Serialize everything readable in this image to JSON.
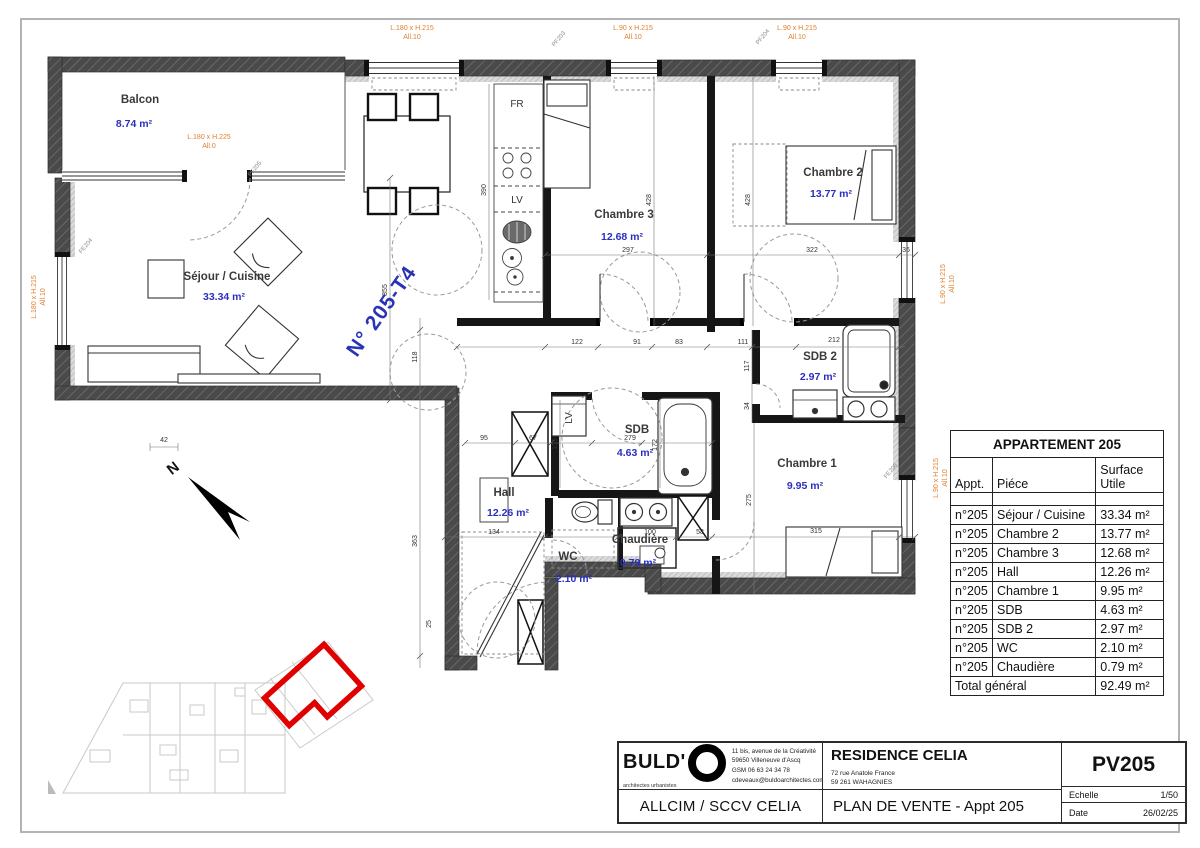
{
  "plan": {
    "unit_label": "N° 205-T4",
    "north": "N",
    "rooms": [
      {
        "name": "Balcon",
        "area": "8.74 m²"
      },
      {
        "name": "Séjour / Cuisine",
        "area": "33.34 m²"
      },
      {
        "name": "Chambre 3",
        "area": "12.68 m²"
      },
      {
        "name": "Chambre 2",
        "area": "13.77 m²"
      },
      {
        "name": "SDB 2",
        "area": "2.97 m²"
      },
      {
        "name": "SDB",
        "area": "4.63 m²"
      },
      {
        "name": "Chambre 1",
        "area": "9.95 m²"
      },
      {
        "name": "Hall",
        "area": "12.26 m²"
      },
      {
        "name": "WC",
        "area": "2.10 m²"
      },
      {
        "name": "Chaudière",
        "area": "0.79 m²"
      }
    ],
    "kitchen": {
      "fridge": "FR",
      "dishwasher": "LV"
    },
    "laundry": "LV",
    "window_labels": [
      {
        "size": "L.180 x H.215",
        "sill": "All.10"
      },
      {
        "size": "L.90 x H.215",
        "sill": "All.10"
      },
      {
        "size": "L.90 x H.215",
        "sill": "All.10"
      },
      {
        "size": "L.180 x H.225",
        "sill": "All.0"
      },
      {
        "size": "L.180 x H.215",
        "sill": "All.10"
      },
      {
        "size": "L.90 x H.215",
        "sill": "All.10"
      },
      {
        "size": "L.90 x H.215",
        "sill": "All.10"
      }
    ],
    "window_tags": [
      "FE204",
      "PF205",
      "PF203",
      "PF204",
      "FE206"
    ],
    "dims": [
      "297",
      "428",
      "428",
      "322",
      "36",
      "390",
      "122",
      "91",
      "83",
      "111",
      "212",
      "117",
      "34",
      "95",
      "67",
      "159",
      "279",
      "172",
      "134",
      "100",
      "58",
      "315",
      "275",
      "355",
      "118",
      "363",
      "42",
      "25"
    ]
  },
  "table": {
    "title": "APPARTEMENT 205",
    "col_appt": "Appt.",
    "col_piece": "Piéce",
    "col_surface": "Surface Utile",
    "rows": [
      {
        "appt": "n°205",
        "piece": "Séjour / Cuisine",
        "surface": "33.34 m²"
      },
      {
        "appt": "n°205",
        "piece": "Chambre 2",
        "surface": "13.77 m²"
      },
      {
        "appt": "n°205",
        "piece": "Chambre 3",
        "surface": "12.68 m²"
      },
      {
        "appt": "n°205",
        "piece": "Hall",
        "surface": "12.26 m²"
      },
      {
        "appt": "n°205",
        "piece": "Chambre 1",
        "surface": "9.95 m²"
      },
      {
        "appt": "n°205",
        "piece": "SDB",
        "surface": "4.63 m²"
      },
      {
        "appt": "n°205",
        "piece": "SDB 2",
        "surface": "2.97 m²"
      },
      {
        "appt": "n°205",
        "piece": "WC",
        "surface": "2.10 m²"
      },
      {
        "appt": "n°205",
        "piece": "Chaudière",
        "surface": "0.79 m²"
      }
    ],
    "total_label": "Total général",
    "total_value": "92.49 m²"
  },
  "titleblock": {
    "brand": "BULD'",
    "brand_sub": "architectes urbanistes",
    "address": [
      "11 bis,  avenue de la Créativité",
      "59650   Villeneuve d'Ascq",
      "GSM    06 63 24 34 78",
      "cdeveaux@buldoarchitectes.com"
    ],
    "client": "ALLCIM / SCCV CELIA",
    "project": "RESIDENCE CELIA",
    "project_address": [
      "72 rue Anatole France",
      "59 261 WAHAGNIES"
    ],
    "doc_title": "PLAN DE VENTE - Appt 205",
    "ref": "PV205",
    "scale_label": "Echelle",
    "scale_value": "1/50",
    "date_label": "Date",
    "date_value": "26/02/25"
  }
}
